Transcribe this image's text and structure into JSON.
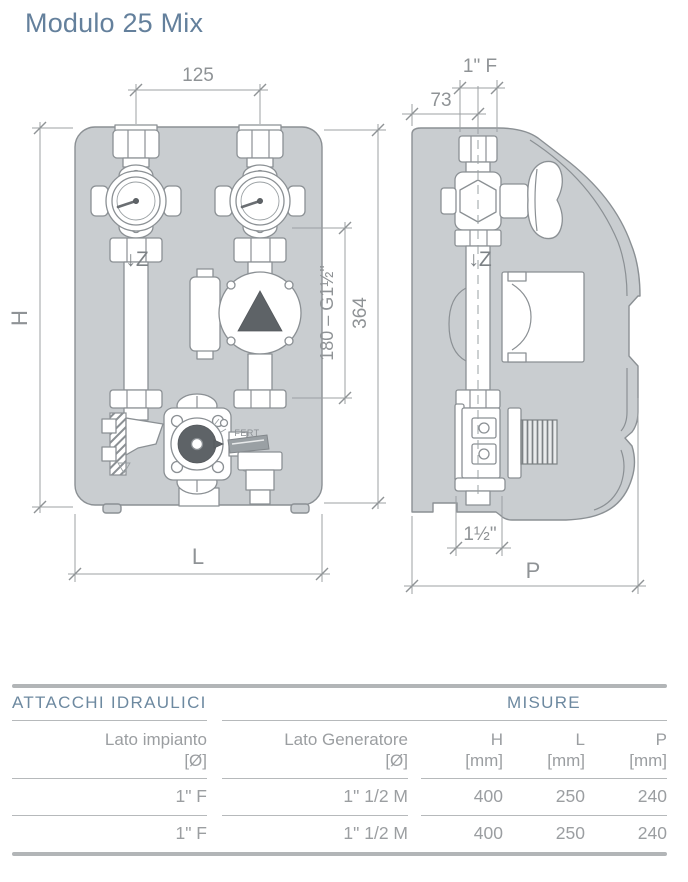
{
  "title": "Modulo 25 Mix",
  "colors": {
    "accent_blue": "#64809c",
    "table_header_blue": "#6d89a0",
    "drawing_gray": "#c9cdd0",
    "text_gray": "#9b9ea1"
  },
  "drawing": {
    "front": {
      "dim_valve_spacing": "125",
      "dim_height_label": "H",
      "dim_width_label": "L",
      "dim_union_span": "180 – G1½\"",
      "dim_overall_height": "364",
      "flow_label": "↓Z",
      "valve_brand": "FERT"
    },
    "side": {
      "dim_top_connection": "1\" F",
      "dim_pipe_offset": "73",
      "flow_label": "↓Z",
      "dim_bottom_connection": "1½\"",
      "dim_depth_label": "P"
    }
  },
  "table": {
    "section_left": "ATTACCHI IDRAULICI",
    "section_right": "MISURE",
    "columns": [
      {
        "line1": "Lato impianto",
        "line2": "[Ø]"
      },
      {
        "line1": "Lato Generatore",
        "line2": "[Ø]"
      },
      {
        "line1": "H",
        "line2": "[mm]"
      },
      {
        "line1": "L",
        "line2": "[mm]"
      },
      {
        "line1": "P",
        "line2": "[mm]"
      }
    ],
    "rows": [
      [
        "1\" F",
        "1\" 1/2 M",
        "400",
        "250",
        "240"
      ],
      [
        "1\" F",
        "1\" 1/2 M",
        "400",
        "250",
        "240"
      ]
    ]
  }
}
